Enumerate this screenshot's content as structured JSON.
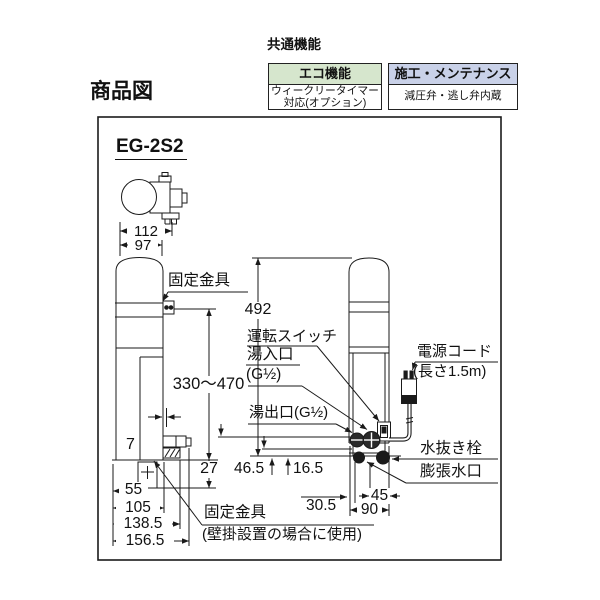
{
  "header": {
    "section_title": "共通機能",
    "page_title": "商品図",
    "feature_boxes": [
      {
        "title": "エコ機能",
        "body_line1": "ウィークリータイマー",
        "body_line2": "対応(オプション)",
        "header_style": "background:#d6e6cd",
        "header_color": "#d6e6cd"
      },
      {
        "title": "施工・メンテナンス",
        "body_line1": "減圧弁・逃し弁内蔵",
        "body_line2": "",
        "header_style": "background:#c9d1e8",
        "header_color": "#c9d1e8"
      }
    ]
  },
  "diagram": {
    "model": "EG-2S2",
    "dimensions": {
      "top_width_overall": "112",
      "top_width_body": "97",
      "height_overall": "492",
      "bracket_adjust_range": "330～470",
      "gap": "7",
      "bracket_drop": "27",
      "port_height": "46.5",
      "drain_offset": "16.5",
      "base_55": "55",
      "base_105": "105",
      "base_138_5": "138.5",
      "base_156_5": "156.5",
      "bottom_30_5": "30.5",
      "bottom_45": "45",
      "bottom_90": "90"
    },
    "labels": {
      "bracket_top": "固定金具",
      "bracket_bottom_line1": "固定金具",
      "bracket_bottom_line2": "(壁掛設置の場合に使用)",
      "operation_switch": "運転スイッチ",
      "hot_water_inlet_line1": "湯入口",
      "hot_water_inlet_line2": "(G½)",
      "hot_water_outlet": "湯出口(G½)",
      "power_cord_line1": "電源コード",
      "power_cord_line2": "(長さ1.5m)",
      "drain_plug": "水抜き栓",
      "expansion_port": "膨張水口"
    },
    "line_color": "#1a1a1a"
  }
}
